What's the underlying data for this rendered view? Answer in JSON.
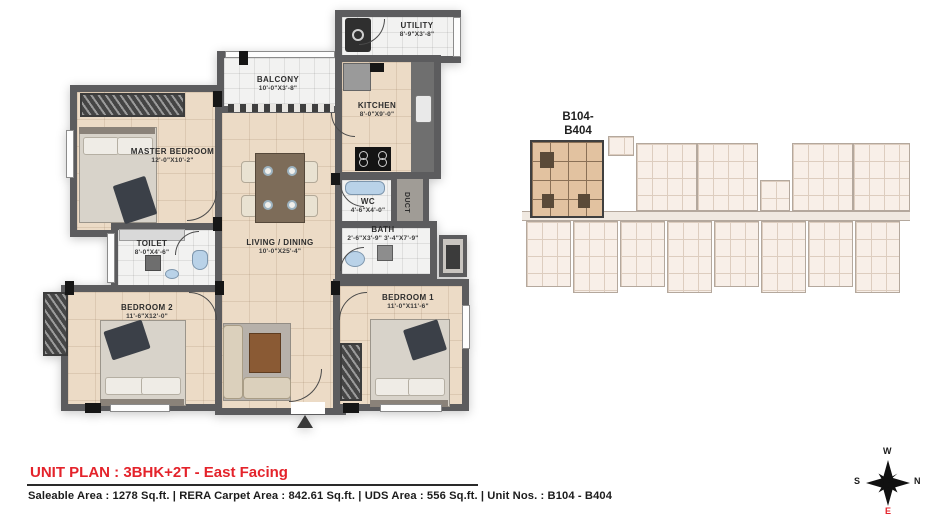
{
  "plan": {
    "rooms": [
      {
        "name": "MASTER BEDROOM",
        "dims": "12'-0\"X10'-2\""
      },
      {
        "name": "BALCONY",
        "dims": "10'-0\"X3'-8\""
      },
      {
        "name": "UTILITY",
        "dims": "8'-9\"X3'-8\""
      },
      {
        "name": "KITCHEN",
        "dims": "8'-0\"X9'-0\""
      },
      {
        "name": "LIVING / DINING",
        "dims": "10'-0\"X25'-4\""
      },
      {
        "name": "WC",
        "dims": "4'-6\"X4'-0\""
      },
      {
        "name": "BATH",
        "dims": "2'-6\"X3'-9\" 3'-4\"X7'-9\""
      },
      {
        "name": "DUCT",
        "dims": ""
      },
      {
        "name": "TOILET",
        "dims": "8'-0\"X4'-6\""
      },
      {
        "name": "BEDROOM 2",
        "dims": "11'-6\"X12'-0\""
      },
      {
        "name": "BEDROOM 1",
        "dims": "11'-0\"X11'-6\""
      }
    ]
  },
  "keyplan": {
    "label_line1": "B104-",
    "label_line2": "B404"
  },
  "footer": {
    "title": "UNIT PLAN : 3BHK+2T - East Facing",
    "details": "Saleable Area : 1278 Sq.ft. | RERA Carpet Area : 842.61 Sq.ft. | UDS Area :  556 Sq.ft. | Unit Nos. : B104 - B404"
  },
  "compass": {
    "w": "W",
    "n": "N",
    "s": "S",
    "e": "E"
  },
  "colors": {
    "accent_red": "#e4232b",
    "wall_gray": "#5c5c5e",
    "floor_beige": "#ecdbc6",
    "floor_white": "#f2f2f1",
    "keyplan_highlight": "#e2c2a0",
    "keyplan_faded": "#f8efe8"
  }
}
